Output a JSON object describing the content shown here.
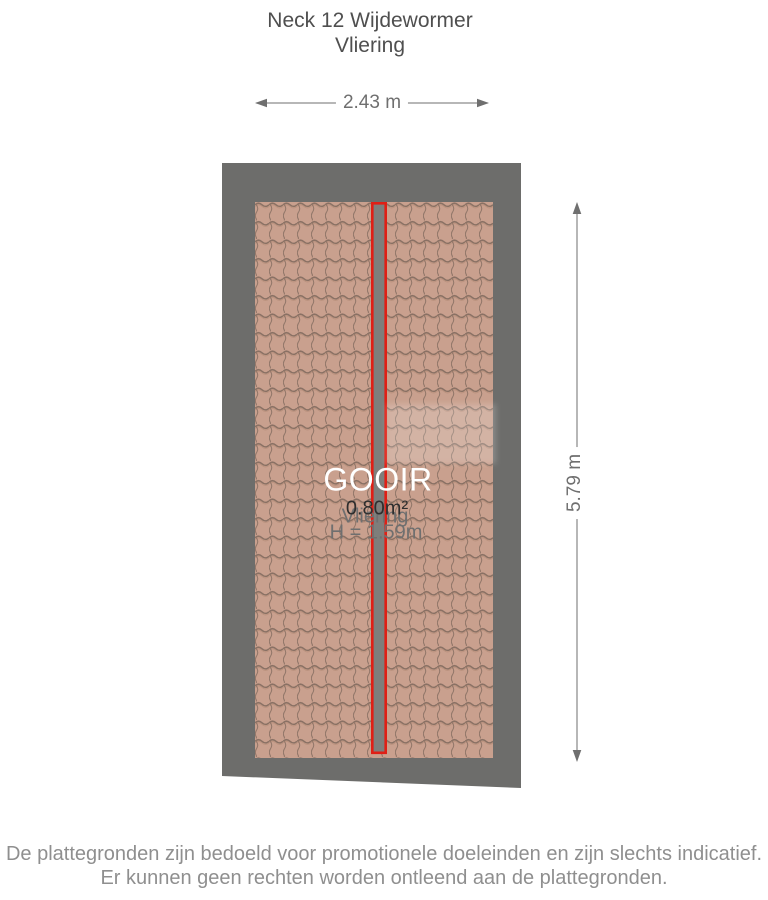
{
  "page": {
    "title_line1": "Neck 12 Wijdewormer",
    "title_line2": "Vliering"
  },
  "floorplan": {
    "watermark": "GOOIR",
    "room": {
      "name": "Vliering",
      "area": "0.80m²",
      "ceiling_height": "H = 1.59m"
    },
    "dimensions": {
      "width": "2.43 m",
      "height": "5.79 m"
    },
    "colors": {
      "frame_gray": "#6d6d6b",
      "roof_tile": "#c9a08e",
      "tile_line": "#8a7164",
      "highlight_red": "#e01f15",
      "dimension_gray": "#6f6f6f"
    }
  },
  "footer": {
    "disclaimer_line1": "De plattegronden zijn bedoeld voor promotionele doeleinden en zijn slechts indicatief.",
    "disclaimer_line2": "Er kunnen geen rechten worden ontleend aan de plattegronden."
  }
}
